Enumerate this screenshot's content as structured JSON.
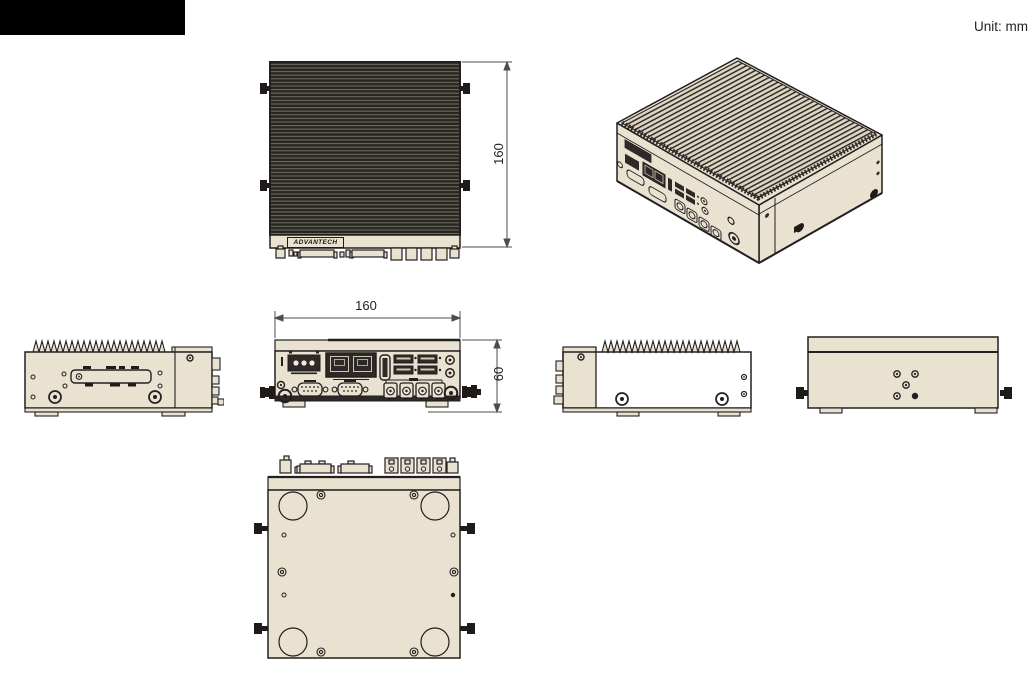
{
  "page": {
    "unit_label": "Unit: mm"
  },
  "branding": {
    "logo_text": "ADVANTECH"
  },
  "dimensions": {
    "unit": "mm",
    "top_view_depth": "160",
    "front_view_width": "160",
    "front_view_height": "60"
  },
  "colors": {
    "chassis_beige": "#e9e2d1",
    "outline_dark": "#231f20",
    "heatsink_dark": "#29251f",
    "heatsink_fin_light": "#6e6963",
    "dim_line_gray": "#4d4d4d",
    "redaction_black": "#000000"
  }
}
